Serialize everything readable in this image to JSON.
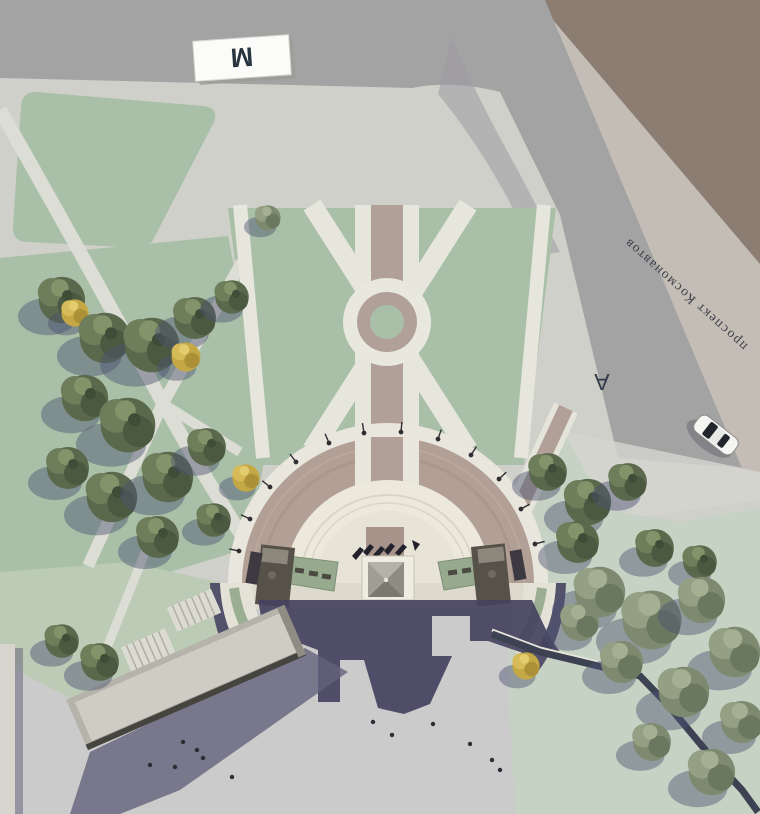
{
  "labels": {
    "metro_sign": "M",
    "street_name": "проспект Космонавтов",
    "bus_stop_marking": "A"
  },
  "colors": {
    "pavement": "#cfd0ca",
    "lower_plaza": "#c7c6ca",
    "road": "#a4a3a3",
    "road_bend_shade": "#9c9aa2",
    "sidewalk": "#c3bdb6",
    "offsite_corner": "#8b7d72",
    "lawn": "#a9bfa7",
    "lawn_pale": "#c6d3c4",
    "lawn_pale_left": "#bccbb6",
    "path_white": "#e7e6dc",
    "brick": "#b1a097",
    "plaza_inner_ring": "#ece9dc",
    "monument_shadow": "#454260",
    "building_roof": "#cfccc4",
    "car_body": "#f5f5f3"
  }
}
